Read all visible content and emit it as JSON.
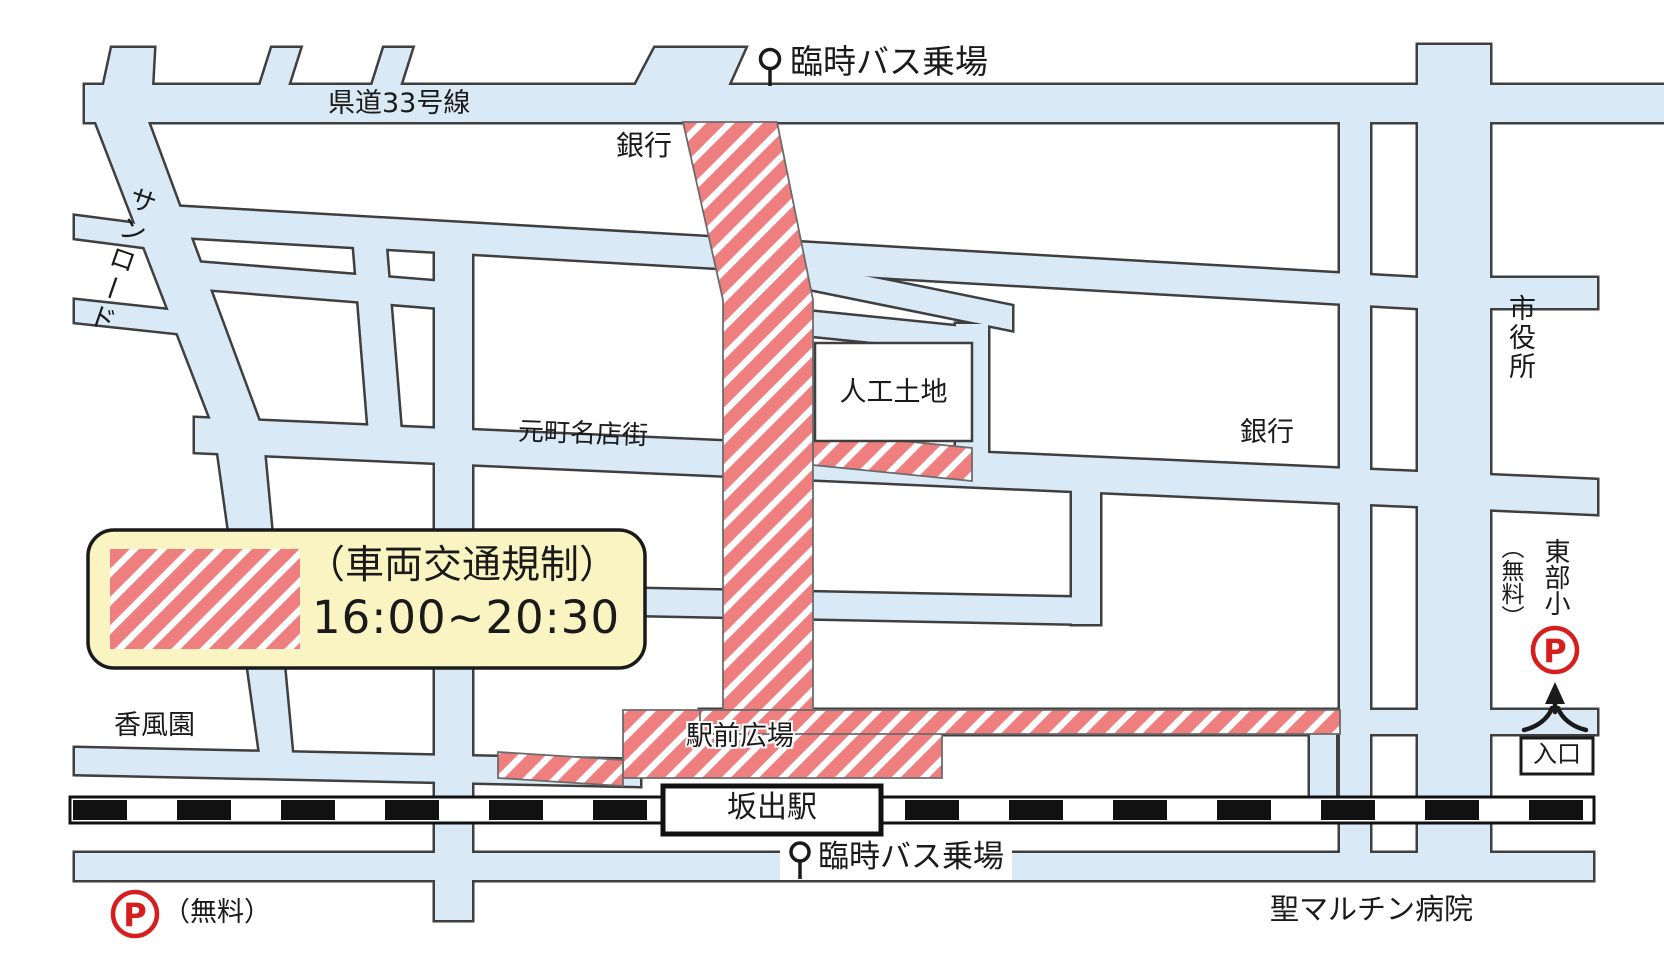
{
  "map": {
    "road_labels": {
      "route33": "県道33号線",
      "sunroad": "サンロード",
      "motomachi": "元町名店街"
    },
    "bus": {
      "top": "臨時バス乗場",
      "bottom": "臨時バス乗場"
    },
    "places": {
      "bank_top": "銀行",
      "bank_right": "銀行",
      "jinko": "人工土地",
      "city_hall": "市役所",
      "kofuen": "香風園",
      "plaza": "駅前広場",
      "hospital": "聖マルチン病院",
      "tobu": "東部小"
    },
    "station": {
      "name": "坂出駅"
    },
    "parking": {
      "letter": "P",
      "free_left": "（無料）",
      "free_right": "（無料）",
      "entrance": "入口"
    },
    "legend": {
      "line1": "（車両交通規制）",
      "line2": "16:00~20:30"
    },
    "colors": {
      "road": "#d9e9f6",
      "road_outline": "#3f3f3f",
      "restricted_red": "#ee7f7e",
      "legend_bg": "#faf4c2",
      "parking_red": "#d61e1e",
      "railway": "#111111"
    }
  }
}
